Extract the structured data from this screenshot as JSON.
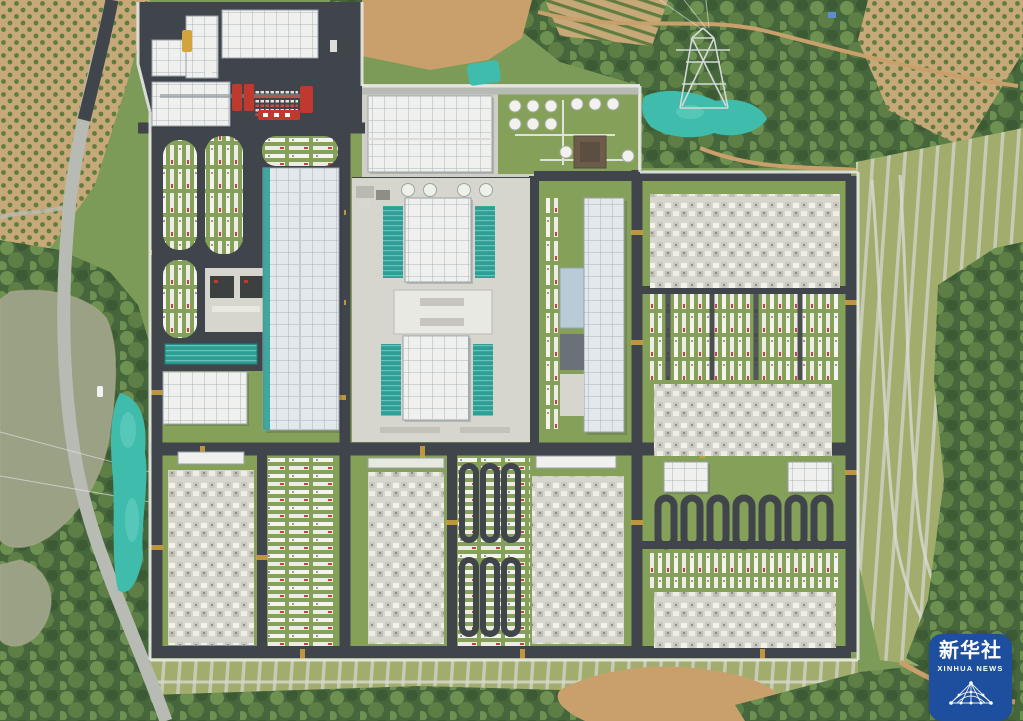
{
  "scene": {
    "alt": "Aerial top-down view of a large power converter station with white valve halls, teal cooling banks, switchyard equipment grids and dark asphalt roads, surrounded by green hills, orchards, a pond and a country road"
  },
  "watermark": {
    "name_cn": "新华社",
    "name_en": "XINHUA NEWS"
  },
  "palette": {
    "veg_base": "#7c9a58",
    "veg_dark": "#46663c",
    "veg_mid": "#5d7f46",
    "veg_mid2": "#6d9150",
    "veg_dark2": "#3c5a34",
    "grass": "#85a058",
    "grass_light": "#a2ac6c",
    "tree_dot": "#5f7d40",
    "orchard_tan": "#c7a878",
    "dirt": "#c9a06c",
    "water": "#9aa184",
    "road_light": "#b8bbb3",
    "asphalt": "#40454c",
    "pad": "#d6d6cf",
    "pad_light": "#cfcfc8",
    "roof_white": "#f0f1ee",
    "roof_blue": "#e3e8ec",
    "roof_grid": "#aab3bc",
    "roof_edge": "#98a0a8",
    "teal": "#2f9f95",
    "tarp": "#3fbcac",
    "wall": "#e9eae4",
    "red": "#c0392f",
    "yellow": "#d4a43c",
    "xinhua_blue": "#1e4f9f",
    "dark_unit": "#3c4140",
    "brown_bldg": "#6e5c4b",
    "attach_blue": "#b9cbd6",
    "attach_dark": "#6b7178"
  }
}
